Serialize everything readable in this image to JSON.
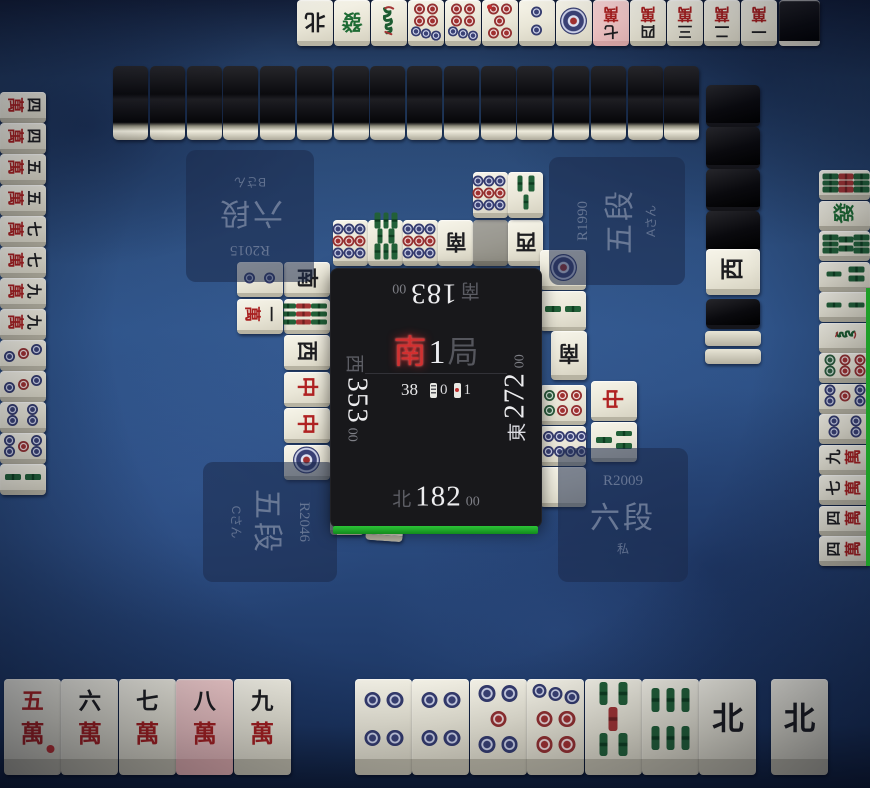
{
  "colors": {
    "turn_indicator_green": "#1e9e28",
    "selected_tile_pink": "#efc4c4",
    "round_wind_red": "#d23030",
    "felt_blue": "#2f548a"
  },
  "glyphs": {
    "man_numbers": {
      "1": "一",
      "2": "二",
      "3": "三",
      "4": "四",
      "5": "五",
      "6": "六",
      "7": "七",
      "8": "八",
      "9": "九"
    },
    "man_suit": "萬",
    "honors": {
      "E": "東",
      "S": "南",
      "W": "西",
      "N": "北",
      "C": "中",
      "F": "發",
      "P": ""
    }
  },
  "center": {
    "round_wind": "南",
    "round_num": "1",
    "round_suffix": "局",
    "tiles_left": "38",
    "honba_count": "0",
    "riichi_count": "1",
    "seats": {
      "top": {
        "wind": "南",
        "score": "183",
        "small": "00"
      },
      "right": {
        "wind": "東",
        "score": "272",
        "small": "00"
      },
      "bottom": {
        "wind": "北",
        "score": "182",
        "small": "00"
      },
      "left": {
        "wind": "西",
        "score": "353",
        "small": "00"
      }
    }
  },
  "plates": {
    "top": {
      "rate": "R2015",
      "rank": "六段",
      "name": "Bさん"
    },
    "right": {
      "rate": "R1990",
      "rank": "五段",
      "name": "Aさん"
    },
    "left": {
      "rate": "R2046",
      "rank": "五段",
      "name": "Cさん"
    },
    "self": {
      "rate": "R2009",
      "rank": "六段",
      "name": "私"
    }
  },
  "hands": {
    "top": {
      "tiles": [
        "zN",
        "zF",
        "s1",
        "p7",
        "p7",
        "p5r",
        "p2",
        "p1",
        "m7",
        "m4",
        "m3",
        "m2",
        "m1"
      ],
      "highlight_index": 8,
      "extra_facedown": 1
    },
    "left": {
      "tiles": [
        "m4",
        "m4",
        "m5",
        "m5",
        "m7",
        "m7",
        "m9",
        "m9",
        "p3",
        "p3",
        "p4",
        "p5",
        "s2"
      ]
    },
    "right": {
      "tiles": [
        "s9",
        "zF",
        "s8",
        "s3",
        "s2",
        "s1",
        "p6",
        "p5",
        "p4",
        "m9",
        "m7",
        "m4",
        "m4"
      ],
      "riichi_bar": true
    },
    "bottom": {
      "main": [
        "m5r",
        "m6",
        "m7",
        "m8",
        "m9"
      ],
      "highlight_main_index": 3,
      "mid": [
        "p4",
        "p4",
        "p5",
        "p7",
        "s5",
        "s6",
        "zN"
      ],
      "drawn": "zN"
    }
  },
  "discards": {
    "bottom": {
      "row1": [
        "zS",
        "zP",
        "zW",
        "zF",
        "s2",
        "p1"
      ],
      "row2": [
        "zE"
      ],
      "last": "p3"
    },
    "top": {
      "row1": [
        "p9",
        "s8",
        "p9",
        "zS",
        "zP!",
        "zW"
      ],
      "row2": [
        "p9",
        "s3"
      ]
    },
    "left": {
      "col1": [
        "zS",
        "s9",
        "zW",
        "zC",
        "zC",
        "p1"
      ],
      "col2": [
        "p2",
        "m1"
      ]
    },
    "right": {
      "col1_before": [
        "p1",
        "s2"
      ],
      "riichi_tile": "zS",
      "col1_after": [
        "p6",
        "p8",
        "zP"
      ],
      "col2": [
        "zC",
        "s3"
      ]
    }
  },
  "walls": {
    "top_count": 16,
    "right": {
      "blacks_above": 4,
      "dora_indicator": "zW",
      "blacks_below": 1,
      "slabs": 2
    }
  }
}
